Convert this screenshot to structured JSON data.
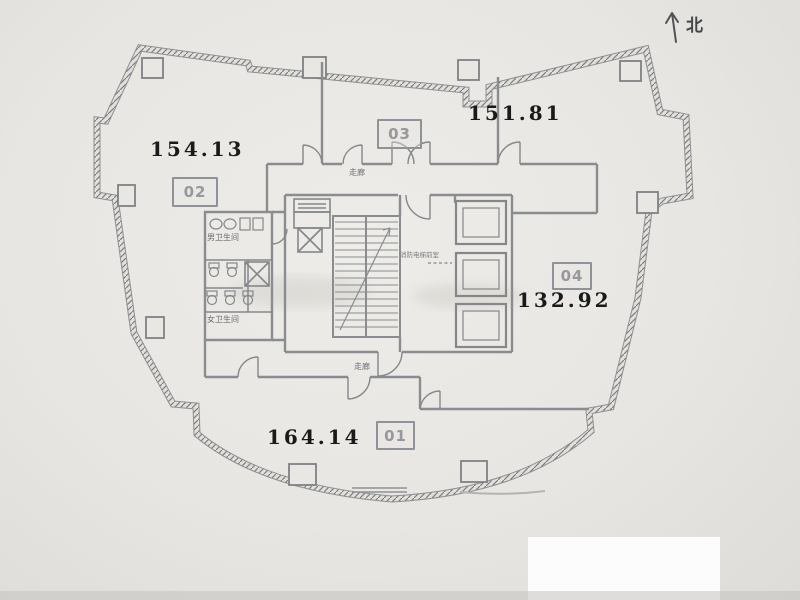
{
  "north": {
    "label": "北"
  },
  "units": [
    {
      "id": "01",
      "area": "164.14"
    },
    {
      "id": "02",
      "area": "154.13"
    },
    {
      "id": "03",
      "area": "151.81"
    },
    {
      "id": "04",
      "area": "132.92"
    }
  ],
  "core_labels": {
    "corridor_top": "走廊",
    "corridor_bottom": "走廊",
    "mens_restroom": "男卫生间",
    "womens_restroom": "女卫生间",
    "fire_elevator_lobby": "消防电梯前室"
  },
  "colors": {
    "paper": "#e9e7e3",
    "ink": "#1a1a1a",
    "wall_gray": "#8e9093",
    "label_gray": "#96989c"
  }
}
